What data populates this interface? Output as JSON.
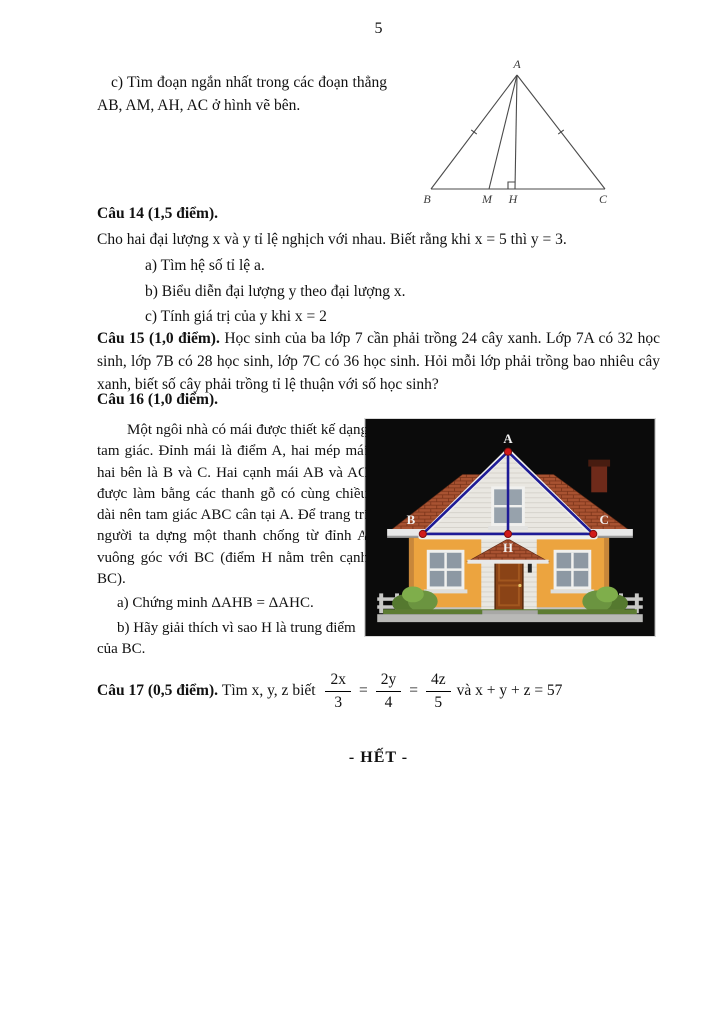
{
  "page": {
    "number": "5"
  },
  "question13c": {
    "text": "c) Tìm đoạn ngắn nhất trong các đoạn thẳng AB, AM, AH, AC ở hình vẽ bên."
  },
  "triangle_figure": {
    "labels": {
      "A": "A",
      "B": "B",
      "M": "M",
      "H": "H",
      "C": "C"
    }
  },
  "cau14": {
    "heading": "Câu 14 (1,5 điểm).",
    "intro": "Cho hai đại lượng x và y tỉ lệ nghịch với nhau. Biết rằng khi x = 5 thì y = 3.",
    "items": [
      "a) Tìm hệ số tỉ lệ a.",
      "b) Biểu diễn đại lượng y theo đại lượng x.",
      "c) Tính giá trị của y khi x = 2"
    ]
  },
  "cau15": {
    "heading": "Câu 15 (1,0 điểm).",
    "body": " Học sinh của ba lớp 7 cần phải trồng 24 cây xanh. Lớp 7A có 32 học sinh, lớp 7B có 28 học sinh, lớp 7C có 36 học sinh. Hỏi mỗi lớp phải trồng bao nhiêu cây xanh, biết số cây phải trồng tỉ lệ thuận với số học sinh?"
  },
  "cau16": {
    "heading": "Câu 16 (1,0 điểm).",
    "paragraph": "Một ngôi nhà có mái được thiết kế dạng tam giác. Đỉnh mái là điểm A, hai mép mái hai bên là B và C. Hai cạnh mái AB và AC được làm bằng các thanh gỗ có cùng chiều dài nên tam giác ABC cân tại A. Để trang trí người ta dựng một thanh chống từ đỉnh A vuông góc với BC (điểm H nằm trên cạnh BC).",
    "items": [
      "a) Chứng minh ΔAHB = ΔAHC.",
      "b) Hãy giải thích vì sao H là trung điểm của BC."
    ],
    "house_labels": {
      "A": "A",
      "B": "B",
      "C": "C",
      "H": "H"
    }
  },
  "cau17": {
    "heading": "Câu 17 (0,5 điểm). ",
    "prefix": "Tìm x, y, z biết ",
    "eq": "=",
    "fractions": [
      {
        "num": "2x",
        "den": "3"
      },
      {
        "num": "2y",
        "den": "4"
      },
      {
        "num": "4z",
        "den": "5"
      }
    ],
    "suffix": "và x + y + z = 57"
  },
  "footer": {
    "end_label": "-  HẾT -"
  },
  "colors": {
    "truss_blue": "#1e1b96",
    "vertex_red": "#d21a1a",
    "roof_tile": "#a85231",
    "wall_orange": "#eca43f"
  }
}
